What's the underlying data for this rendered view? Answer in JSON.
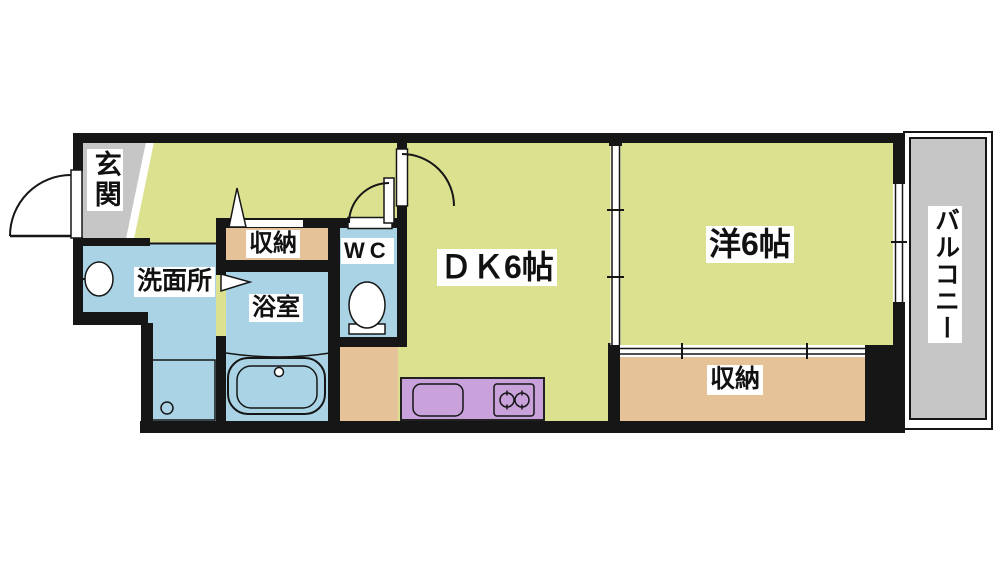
{
  "rooms": {
    "genkan": "玄関",
    "washroom": "洗面所",
    "storage_upper": "収納",
    "wc": "WC",
    "bathroom": "浴室",
    "dk": "ＤＫ6帖",
    "western": "洋6帖",
    "storage_lower": "収納",
    "balcony": "バルコニー"
  },
  "colors": {
    "room_floor": "#dce18f",
    "wet_area": "#aad4e6",
    "storage": "#e5c298",
    "kitchen_counter": "#c9a2dc",
    "entrance_balcony": "#c6c6c7",
    "wall": "#161616"
  }
}
